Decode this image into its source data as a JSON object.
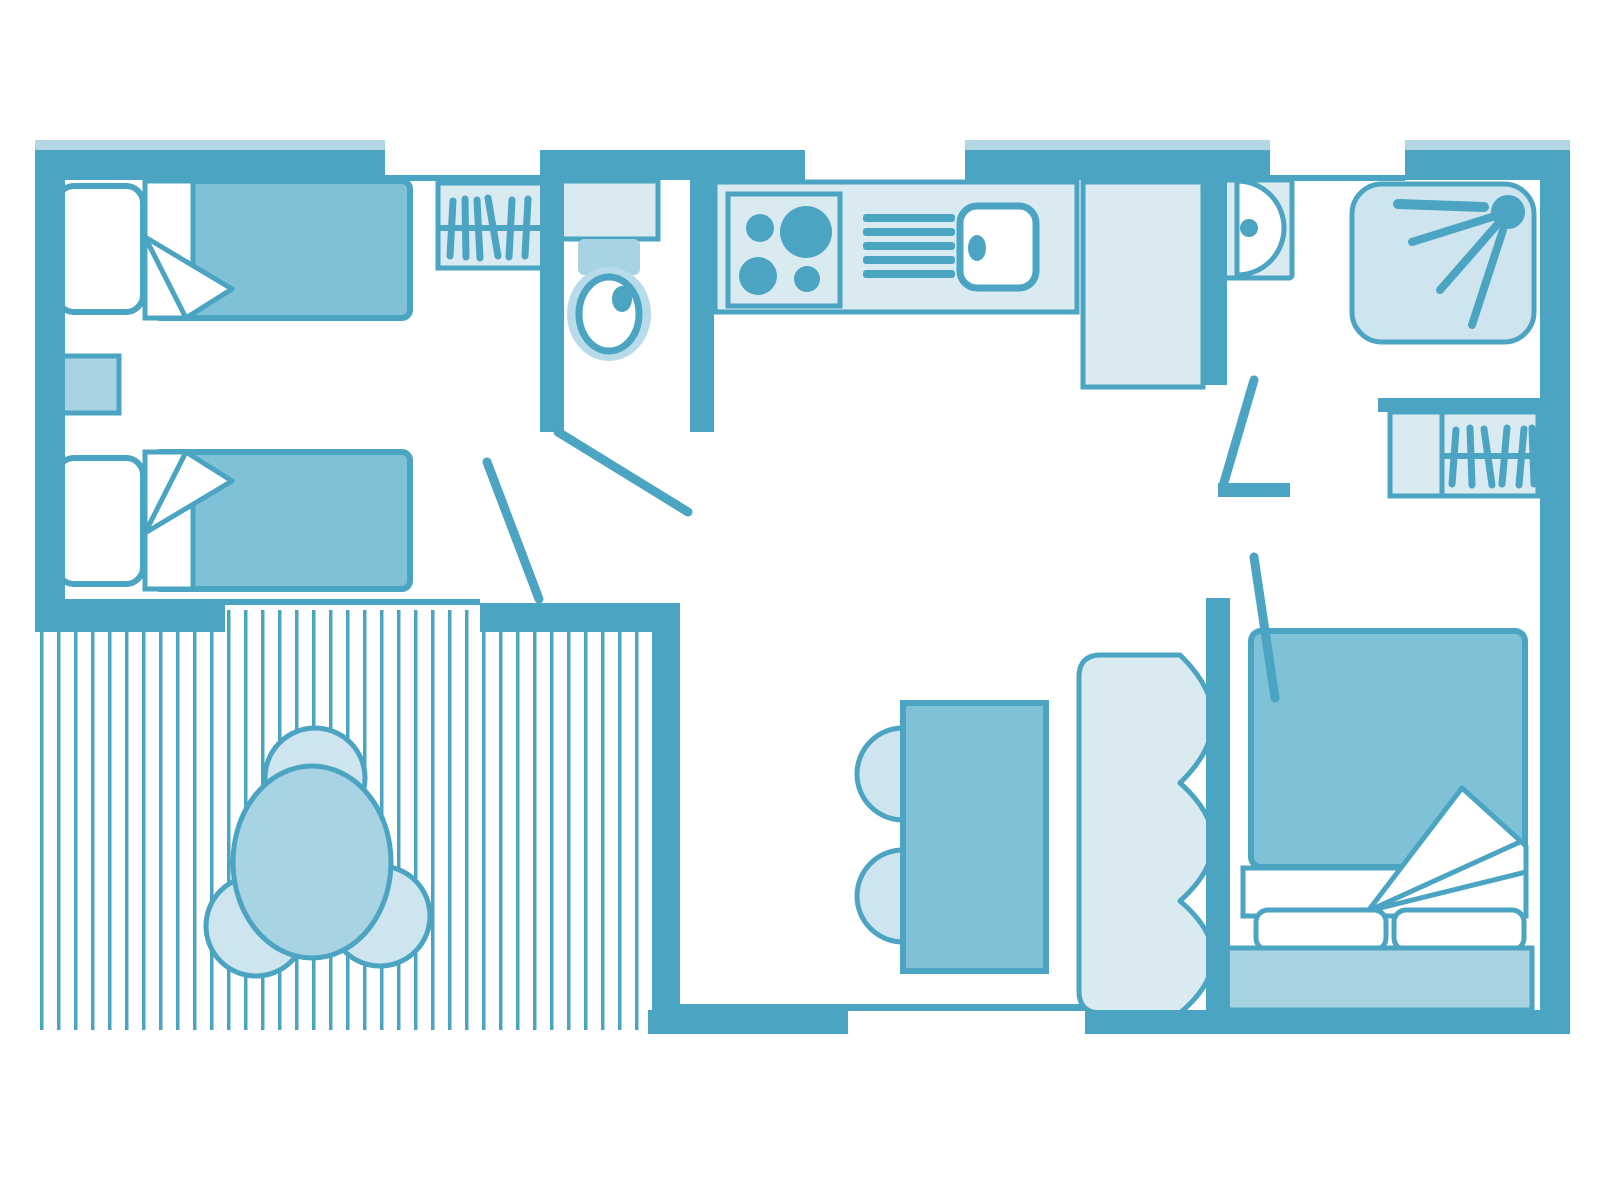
{
  "palette": {
    "wall": "#4ba4c2",
    "pale": "#b3d7e5",
    "light": "#d9eaf1",
    "mid": "#7fc1d6",
    "midlight": "#a8d3e3",
    "chair": "#cee4ef",
    "halo": "#b7dbe9",
    "paper": "#ffffff"
  },
  "plan": {
    "type": "mobile-home-floor-plan",
    "rooms": {
      "twin_bedroom": {
        "items": [
          "single-bed",
          "single-bed",
          "nightstand",
          "wardrobe-hangers"
        ]
      },
      "toilet_room": {
        "items": [
          "toilet-cistern",
          "toilet-bowl"
        ]
      },
      "kitchen": {
        "items": [
          "hob-four-burners",
          "dish-drainer",
          "sink",
          "fridge-cabinet"
        ]
      },
      "bathroom": {
        "items": [
          "washbasin",
          "shower"
        ]
      },
      "master_bedroom": {
        "items": [
          "double-bed",
          "wardrobe-hangers"
        ]
      },
      "living_dining": {
        "items": [
          "dining-table",
          "dining-chair",
          "dining-chair",
          "bench-seat"
        ]
      },
      "terrace": {
        "items": [
          "deck-boards",
          "round-table",
          "terrace-chair",
          "terrace-chair",
          "terrace-chair"
        ]
      }
    },
    "doors": [
      "entrance-door-swing",
      "toilet-door-swing",
      "bathroom-door-swing",
      "master-bedroom-door-swing"
    ],
    "window_openings": 3,
    "entrance_openings": 2
  }
}
